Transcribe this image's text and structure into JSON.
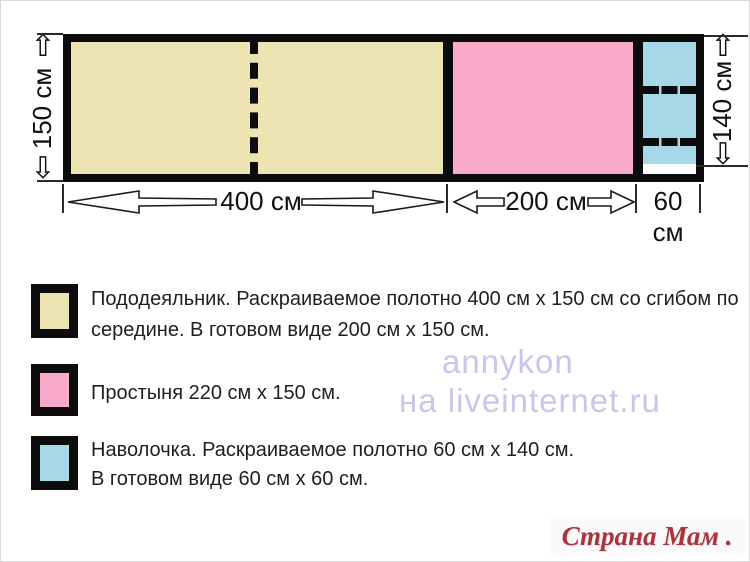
{
  "diagram": {
    "height_label_left": "150 см",
    "height_label_right": "140 см",
    "width_label_duvet": "400 см",
    "width_label_sheet": "200 см",
    "width_label_pillow": "60 см",
    "colors": {
      "duvet": "#ece4b3",
      "sheet": "#f9aacb",
      "pillow": "#a6d8e7",
      "outline": "#0c0c0c"
    }
  },
  "icons": {
    "arrow_up": "⇧",
    "arrow_down": "⇩"
  },
  "legend": {
    "items": [
      {
        "name": "duvet-cover",
        "color": "#ece4b3",
        "lines": [
          "Пододеяльник. Раскраиваемое полотно 400 см х 150 см со сгибом по",
          "середине. В готовом виде 200 см х 150 см."
        ]
      },
      {
        "name": "sheet",
        "color": "#f9aacb",
        "lines": [
          "Простыня 220 см  х 150 см."
        ]
      },
      {
        "name": "pillowcase",
        "color": "#a6d8e7",
        "lines": [
          "Наволочка. Раскраиваемое полотно 60 см х 140 см.",
          "В готовом виде 60 см х 60 см."
        ]
      }
    ]
  },
  "watermarks": {
    "annykon": "annykon",
    "liveinternet": "на liveinternet.ru",
    "strana_mam": "Страна Мам . ру"
  }
}
